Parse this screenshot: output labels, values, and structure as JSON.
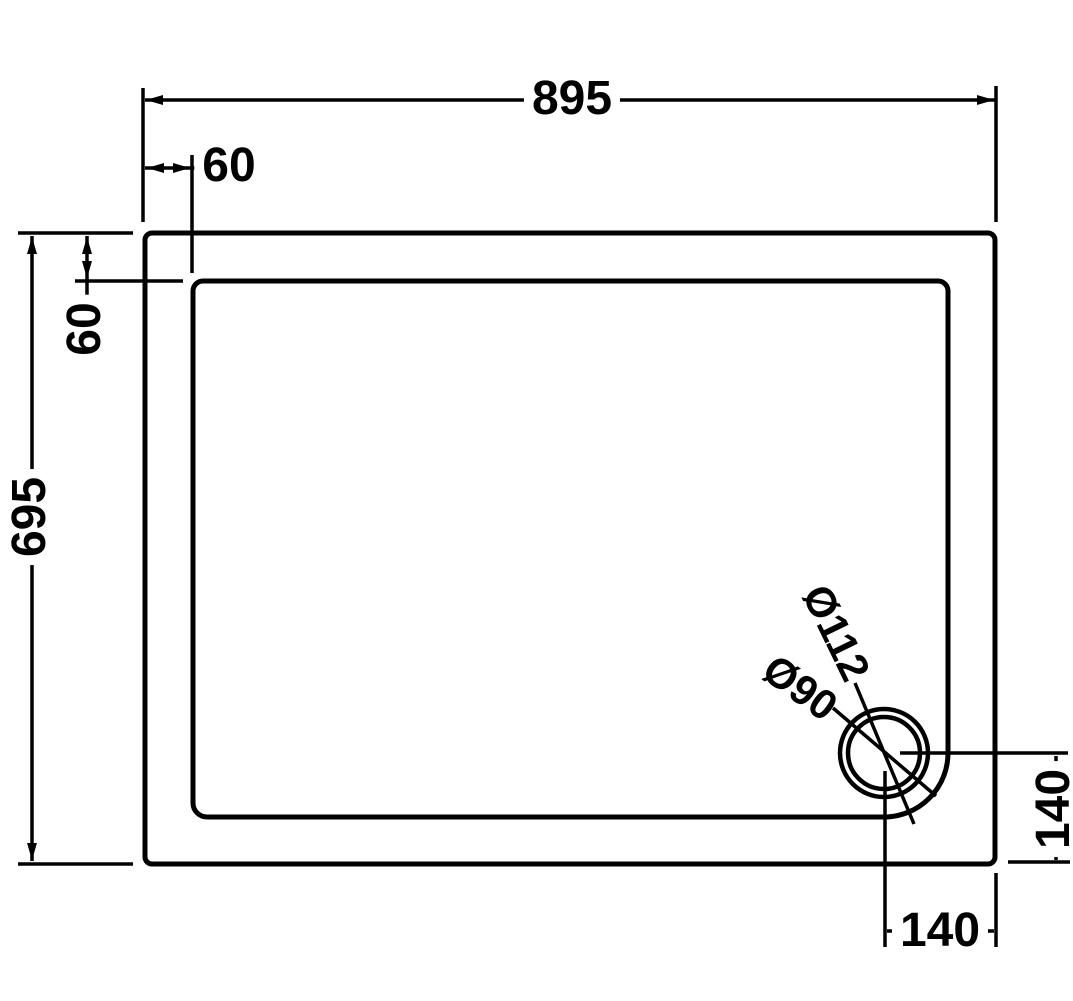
{
  "drawing": {
    "type": "technical-plan-shower-tray",
    "colors": {
      "line": "#000000",
      "background": "#ffffff"
    },
    "labels": {
      "overall_width": "895",
      "top_edge_inset": "60",
      "overall_depth": "695",
      "side_edge_inset": "60",
      "waste_to_right_edge": "140",
      "waste_to_bottom_edge": "140",
      "waste_flange_diameter": "Ø112",
      "waste_hole_diameter": "Ø90"
    }
  }
}
